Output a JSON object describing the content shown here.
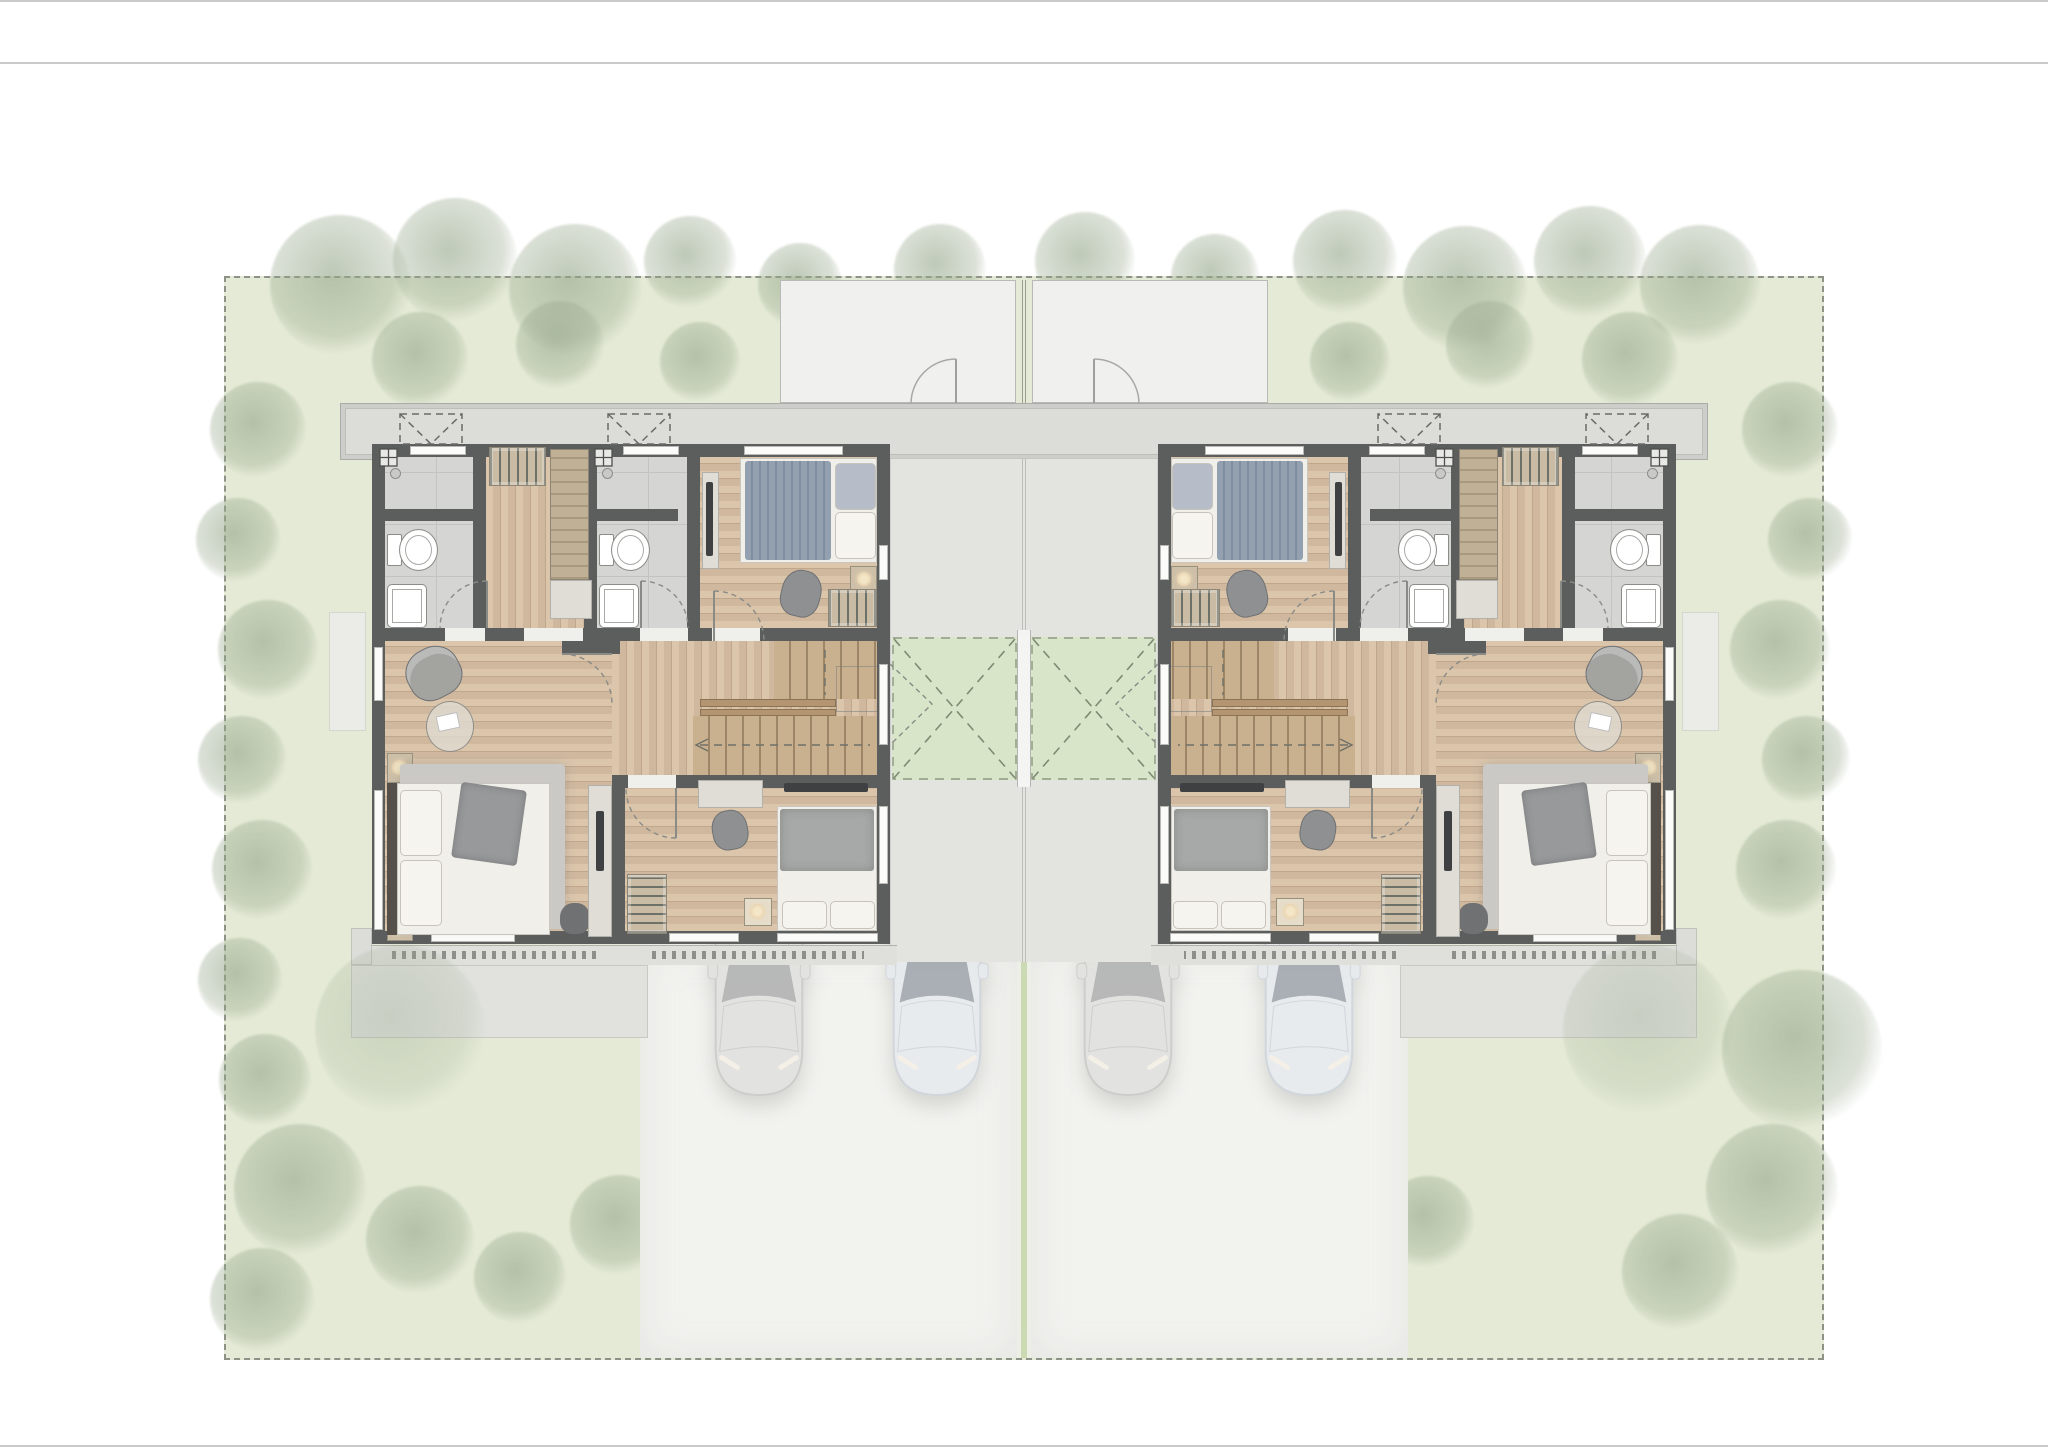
{
  "document": {
    "type": "architectural-floor-plan",
    "view": "second-floor-plan-top-view",
    "visible_text": [],
    "page": {
      "width_px": 2048,
      "height_px": 1447,
      "background": "#ffffff",
      "header_rule_y": 62
    }
  },
  "palette": {
    "lawn": "#e4ead6",
    "site_border": "#8d9287",
    "wall": "#5c5d5d",
    "wood_floor": "#cfb89e",
    "tile_floor": "#d5d6d4",
    "concrete": "#e3e3e0",
    "driveway": "#f2f2ef",
    "porch": "#f0f1ee",
    "eave": "#dcddd9",
    "void_garden": "#d9e5c9",
    "rug": "#cbc9c5",
    "duvet_blue": "#93a0b0",
    "car_gray": "#d8d8d6",
    "car_blue": "#e0e6ed",
    "tree": "#97a88c",
    "lamp": "#ecd9b6"
  },
  "site": {
    "boundary": "dashed",
    "elements": [
      "lawn",
      "perimeter-trees",
      "hedges",
      "ghost-ground-floor-porches",
      "ghost-side-terraces",
      "central-courtyard",
      "two-driveways",
      "center-path-strip"
    ]
  },
  "units": [
    {
      "id": "unit-left",
      "mirrored": false,
      "rooms": [
        "bathroom-1",
        "dressing-corridor",
        "bathroom-2",
        "front-bedroom",
        "hall",
        "staircase",
        "master-bedroom",
        "rear-bedroom"
      ],
      "fixtures": [
        "toilet-2x",
        "sink-2x",
        "walk-in-wardrobe",
        "tall-cabinet",
        "beds-3x",
        "nightstands",
        "armchair",
        "round-table",
        "tv-consoles",
        "desk-chair",
        "void-terrace-door",
        "ac-units-2x"
      ]
    },
    {
      "id": "unit-right",
      "mirrored": true,
      "rooms": [
        "bathroom-1",
        "dressing-corridor",
        "bathroom-2",
        "front-bedroom",
        "hall",
        "staircase",
        "master-bedroom",
        "rear-bedroom"
      ],
      "fixtures": [
        "toilet-2x",
        "sink-2x",
        "walk-in-wardrobe",
        "tall-cabinet",
        "beds-3x",
        "nightstands",
        "armchair",
        "round-table",
        "tv-consoles",
        "desk-chair",
        "void-terrace-door",
        "ac-units-2x"
      ]
    }
  ],
  "cars": [
    {
      "variant": "gray",
      "x": 700,
      "y": 845
    },
    {
      "variant": "blue",
      "x": 878,
      "y": 845
    },
    {
      "variant": "gray",
      "x": 1069,
      "y": 845
    },
    {
      "variant": "blue",
      "x": 1250,
      "y": 845
    }
  ],
  "vegetation": {
    "trees": [
      [
        340,
        285,
        70
      ],
      [
        455,
        260,
        62
      ],
      [
        575,
        290,
        66
      ],
      [
        690,
        262,
        46
      ],
      [
        800,
        285,
        42
      ],
      [
        940,
        270,
        46
      ],
      [
        1085,
        262,
        50
      ],
      [
        1215,
        278,
        44
      ],
      [
        1345,
        262,
        52
      ],
      [
        1465,
        288,
        62
      ],
      [
        1590,
        262,
        56
      ],
      [
        1700,
        285,
        60
      ],
      [
        420,
        360,
        48
      ],
      [
        560,
        345,
        44
      ],
      [
        700,
        362,
        40
      ],
      [
        850,
        345,
        38
      ],
      [
        990,
        358,
        40
      ],
      [
        1060,
        358,
        40
      ],
      [
        1200,
        345,
        38
      ],
      [
        1350,
        362,
        40
      ],
      [
        1490,
        345,
        44
      ],
      [
        1630,
        360,
        48
      ],
      [
        258,
        430,
        48
      ],
      [
        238,
        540,
        42
      ],
      [
        268,
        650,
        50
      ],
      [
        242,
        760,
        44
      ],
      [
        262,
        870,
        50
      ],
      [
        240,
        980,
        42
      ],
      [
        265,
        1080,
        46
      ],
      [
        1790,
        430,
        48
      ],
      [
        1810,
        540,
        42
      ],
      [
        1780,
        650,
        50
      ],
      [
        1806,
        760,
        44
      ],
      [
        1786,
        870,
        50
      ],
      [
        1802,
        1050,
        80
      ],
      [
        300,
        1190,
        66
      ],
      [
        262,
        1300,
        52
      ],
      [
        420,
        1240,
        54
      ],
      [
        520,
        1278,
        46
      ],
      [
        620,
        1225,
        50
      ],
      [
        720,
        1272,
        44
      ],
      [
        820,
        1232,
        42
      ],
      [
        1130,
        1262,
        44
      ],
      [
        1232,
        1212,
        50
      ],
      [
        1332,
        1270,
        54
      ],
      [
        1428,
        1222,
        46
      ],
      [
        1680,
        1272,
        58
      ],
      [
        1772,
        1190,
        66
      ],
      [
        400,
        1030,
        85
      ],
      [
        1648,
        1030,
        85
      ]
    ]
  }
}
